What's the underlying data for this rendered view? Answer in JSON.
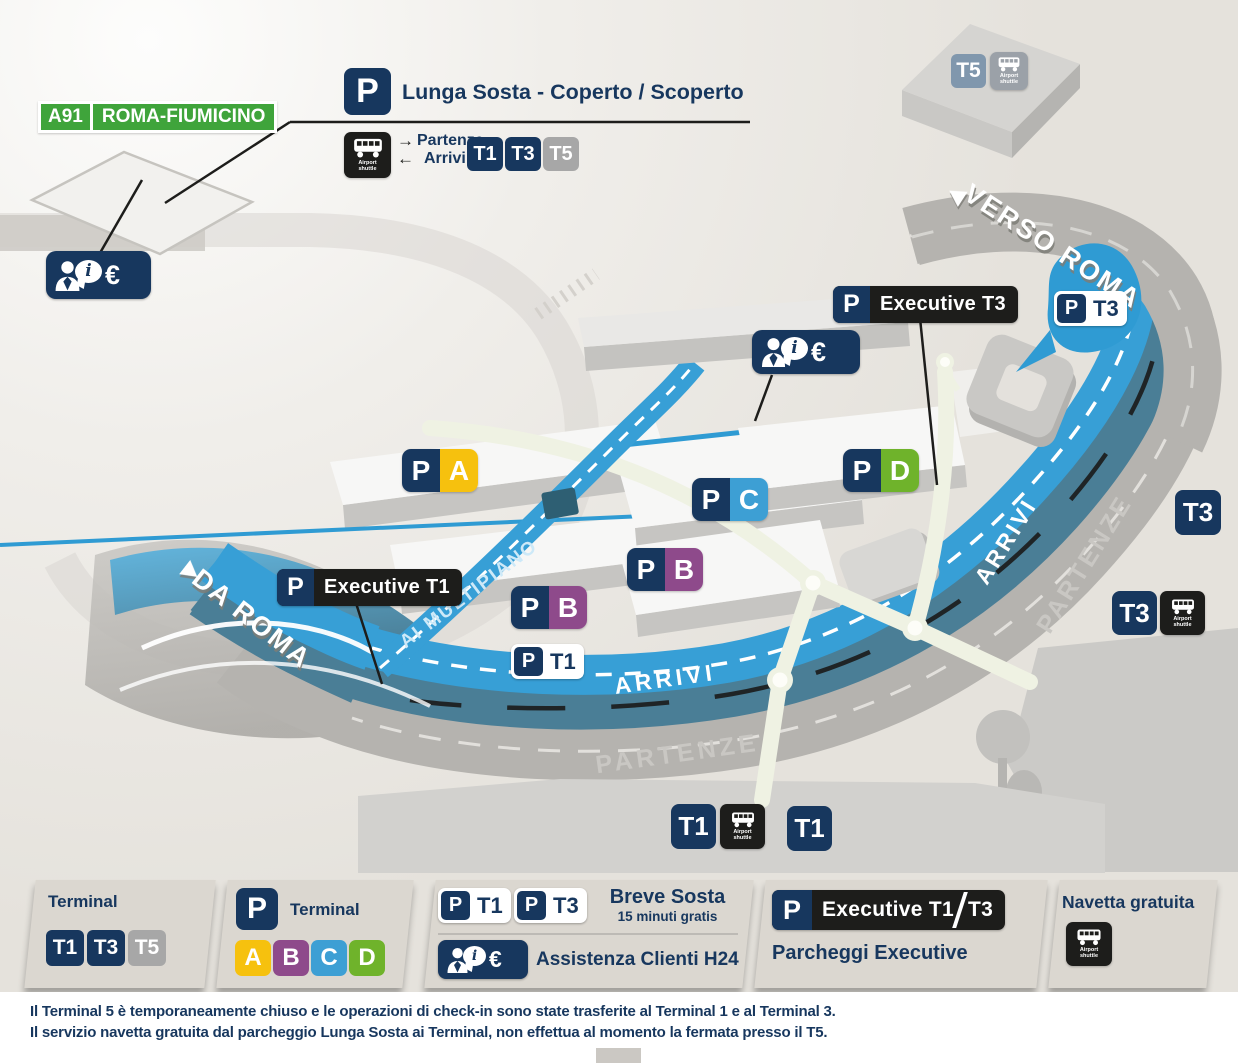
{
  "colors": {
    "navy": "#17375e",
    "road_blue": "#379fd6",
    "road_teal": "#4a7e96",
    "road_gray": "#b5b3af",
    "a91_green": "#3fa43b",
    "yellow": "#f6c10e",
    "purple": "#8e4a8b",
    "light_blue": "#3d9fd4",
    "green": "#6fb32b",
    "black_label": "#1d1d1b"
  },
  "map": {
    "a91_code": "A91",
    "a91_name": "ROMA-FIUMICINO",
    "lunga_p": "P",
    "lunga_title": "Lunga Sosta - Coperto /  Scoperto",
    "partenze": "Partenze",
    "arrivi": "Arrivi",
    "arrow_right": "→",
    "arrow_left": "←",
    "t1": "T1",
    "t3": "T3",
    "t5": "T5",
    "shuttle_caption": "Airport shuttle",
    "verso_roma": "VERSO ROMA",
    "da_roma": "DA ROMA",
    "ai_multipiano": "AI MULTIPIANO",
    "arrivi_road": "ARRIVI",
    "partenze_road": "PARTENZE",
    "p": "P",
    "exec_t3": "Executive T3",
    "exec_t1": "Executive T1",
    "letter_a": "A",
    "letter_b": "B",
    "letter_c": "C",
    "letter_d": "D",
    "info_i": "i",
    "info_euro": "€"
  },
  "legend": {
    "terminal_title": "Terminal",
    "t1": "T1",
    "t3": "T3",
    "t5": "T5",
    "p": "P",
    "p_terminal_title": "Terminal",
    "a": "A",
    "b": "B",
    "c": "C",
    "d": "D",
    "breve_title": "Breve Sosta",
    "breve_sub": "15 minuti gratis",
    "assistenza": "Assistenza Clienti H24",
    "exec_label": "Executive T1",
    "exec_label2": "T3",
    "exec_caption": "Parcheggi Executive",
    "navetta_title": "Navetta gratuita",
    "shuttle_caption": "Airport shuttle",
    "info_i": "i",
    "info_euro": "€"
  },
  "footer": {
    "line1": "Il Terminal 5 è temporaneamente chiuso e le operazioni di check-in sono state trasferite al Terminal 1 e al Terminal 3.",
    "line2": "Il servizio navetta gratuita dal parcheggio Lunga Sosta ai Terminal, non effettua al momento la fermata presso il T5."
  }
}
